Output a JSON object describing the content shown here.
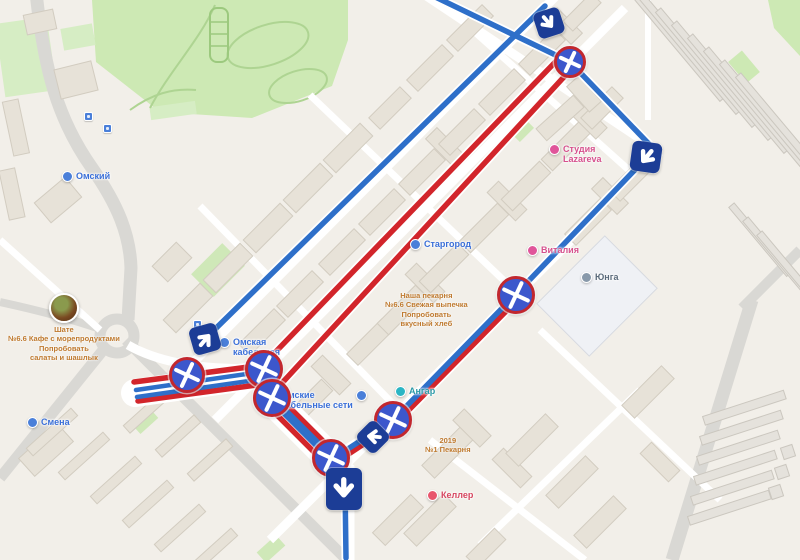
{
  "colors": {
    "route_blue": "#2e6fc9",
    "route_red": "#d2252b",
    "closure_ring": "#c2272e",
    "closure_fill": "#3c57cc",
    "arrow_box": "#1c3d96",
    "park_green": "#cde9b4",
    "building_fill": "#e7e2d8",
    "road_gray": "#d9d8d4"
  },
  "map": {
    "pois": [
      {
        "name": "omskiy",
        "x": 62,
        "y": 171,
        "color": "#4a7fd9",
        "text_color": "#3a6fd8",
        "lines": [
          "Омский"
        ]
      },
      {
        "name": "stargorod",
        "x": 410,
        "y": 239,
        "color": "#4a7fd9",
        "text_color": "#3a6fd8",
        "lines": [
          "Старгород"
        ]
      },
      {
        "name": "studiya-lazareva",
        "x": 549,
        "y": 144,
        "color": "#e0559a",
        "text_color": "#d6518d",
        "lines": [
          "Студия",
          "Lazareva"
        ]
      },
      {
        "name": "vitaliya",
        "x": 527,
        "y": 245,
        "color": "#e0559a",
        "text_color": "#d6518d",
        "lines": [
          "Виталия"
        ]
      },
      {
        "name": "yunga",
        "x": 581,
        "y": 272,
        "color": "#8899aa",
        "text_color": "#5b6b7b",
        "lines": [
          "Юнга"
        ]
      },
      {
        "name": "omskaya-kabelnaya",
        "x": 219,
        "y": 337,
        "color": "#4a7fd9",
        "text_color": "#3a6fd8",
        "lines": [
          "Омская",
          "кабельная"
        ]
      },
      {
        "name": "omskie-kabelnye-seti",
        "x": 281,
        "y": 390,
        "color": "#4a7fd9",
        "text_color": "#3a6fd8",
        "icon_right": true,
        "lines": [
          "Омские",
          "кабельные сети"
        ]
      },
      {
        "name": "smena",
        "x": 27,
        "y": 417,
        "color": "#4a7fd9",
        "text_color": "#3a6fd8",
        "lines": [
          "Смена"
        ]
      },
      {
        "name": "angar",
        "x": 395,
        "y": 386,
        "color": "#2bb5c4",
        "text_color": "#2b9aa8",
        "lines": [
          "Ангар"
        ]
      },
      {
        "name": "keller",
        "x": 427,
        "y": 490,
        "color": "#e8566d",
        "text_color": "#d6455e",
        "lines": [
          "Келлер"
        ]
      }
    ],
    "ads": [
      {
        "name": "nasha-pekarnya",
        "x": 385,
        "y": 291,
        "photo": false,
        "lines": [
          "Наша пекарня",
          "№6.6 Свежая выпечка",
          "Попробовать",
          "вкусный хлеб"
        ]
      },
      {
        "name": "cafe-photo-ad",
        "x": 8,
        "y": 293,
        "photo": true,
        "lines": [
          "Шате",
          "№6.6 Кафе с морепродуктами",
          "Попробовать",
          "салаты и шашлык"
        ]
      },
      {
        "name": "pekarnya-2019",
        "x": 425,
        "y": 436,
        "photo": false,
        "lines": [
          "2019",
          "№1 Пекарня"
        ]
      }
    ],
    "streets": [
      {
        "label": "Березовая ул.",
        "x": 26,
        "y": 86,
        "angle": 78
      },
      {
        "label": "2-я Кольцевая ул.",
        "x": 0,
        "y": 238,
        "angle": 74
      },
      {
        "label": "2-я Кольцевая ул.",
        "x": 148,
        "y": 402,
        "angle": 46
      },
      {
        "label": "ул. Дмитриева",
        "x": 694,
        "y": 386,
        "angle": 70
      }
    ],
    "areas": [
      {
        "label": "Омск-50",
        "x": 712,
        "y": 101
      },
      {
        "label": "Омск-50",
        "x": 664,
        "y": 437
      }
    ],
    "house_numbers": [
      {
        "label": "44/3",
        "x": 464,
        "y": 9
      },
      {
        "label": "44",
        "x": 448,
        "y": 30
      },
      {
        "label": "7/1",
        "x": 508,
        "y": 95
      },
      {
        "label": "11",
        "x": 622,
        "y": 132
      },
      {
        "label": "8",
        "x": 640,
        "y": 188
      },
      {
        "label": "1",
        "x": 246,
        "y": 195
      },
      {
        "label": "4",
        "x": 389,
        "y": 265
      },
      {
        "label": "2",
        "x": 427,
        "y": 403
      },
      {
        "label": "3",
        "x": 468,
        "y": 415
      },
      {
        "label": "3",
        "x": 558,
        "y": 477
      },
      {
        "label": "15",
        "x": 159,
        "y": 439
      },
      {
        "label": "15/3",
        "x": 179,
        "y": 455
      },
      {
        "label": "15/9",
        "x": 147,
        "y": 475
      },
      {
        "label": "15/11",
        "x": 171,
        "y": 491
      },
      {
        "label": "15/16",
        "x": 187,
        "y": 507
      },
      {
        "label": "15/18",
        "x": 129,
        "y": 504
      },
      {
        "label": "15/20",
        "x": 145,
        "y": 520
      },
      {
        "label": "15/24",
        "x": 161,
        "y": 536
      },
      {
        "label": "с318",
        "x": 760,
        "y": 105
      },
      {
        "label": "с364",
        "x": 755,
        "y": 122
      },
      {
        "label": "с299",
        "x": 763,
        "y": 135
      },
      {
        "label": "с296",
        "x": 770,
        "y": 155
      },
      {
        "label": "с197",
        "x": 728,
        "y": 381
      },
      {
        "label": "55",
        "x": 772,
        "y": 388
      },
      {
        "label": "42",
        "x": 782,
        "y": 452
      },
      {
        "label": "46",
        "x": 766,
        "y": 461
      },
      {
        "label": "58",
        "x": 756,
        "y": 480
      }
    ],
    "bus_stops": [
      {
        "x": 84,
        "y": 112
      },
      {
        "x": 103,
        "y": 124
      },
      {
        "x": 193,
        "y": 320
      }
    ],
    "markers": [
      {
        "x": 570,
        "y": 62,
        "s": 32
      },
      {
        "x": 516,
        "y": 295,
        "s": 38
      },
      {
        "x": 187,
        "y": 375,
        "s": 36
      },
      {
        "x": 264,
        "y": 369,
        "s": 38
      },
      {
        "x": 272,
        "y": 398,
        "s": 38
      },
      {
        "x": 331,
        "y": 458,
        "s": 38
      },
      {
        "x": 393,
        "y": 420,
        "s": 38
      }
    ],
    "arrows": [
      {
        "x": 549,
        "y": 23,
        "w": 27,
        "h": 27,
        "box_rot": -18,
        "glyph_abs": -40
      },
      {
        "x": 646,
        "y": 157,
        "w": 30,
        "h": 30,
        "box_rot": 8,
        "glyph_abs": 40
      },
      {
        "x": 205,
        "y": 339,
        "w": 28,
        "h": 28,
        "box_rot": -16,
        "glyph_abs": -140
      },
      {
        "x": 373,
        "y": 437,
        "w": 26,
        "h": 26,
        "box_rot": 45,
        "glyph_abs": 95
      },
      {
        "x": 344,
        "y": 489,
        "w": 36,
        "h": 42,
        "box_rot": 0,
        "glyph_abs": 0
      }
    ]
  }
}
